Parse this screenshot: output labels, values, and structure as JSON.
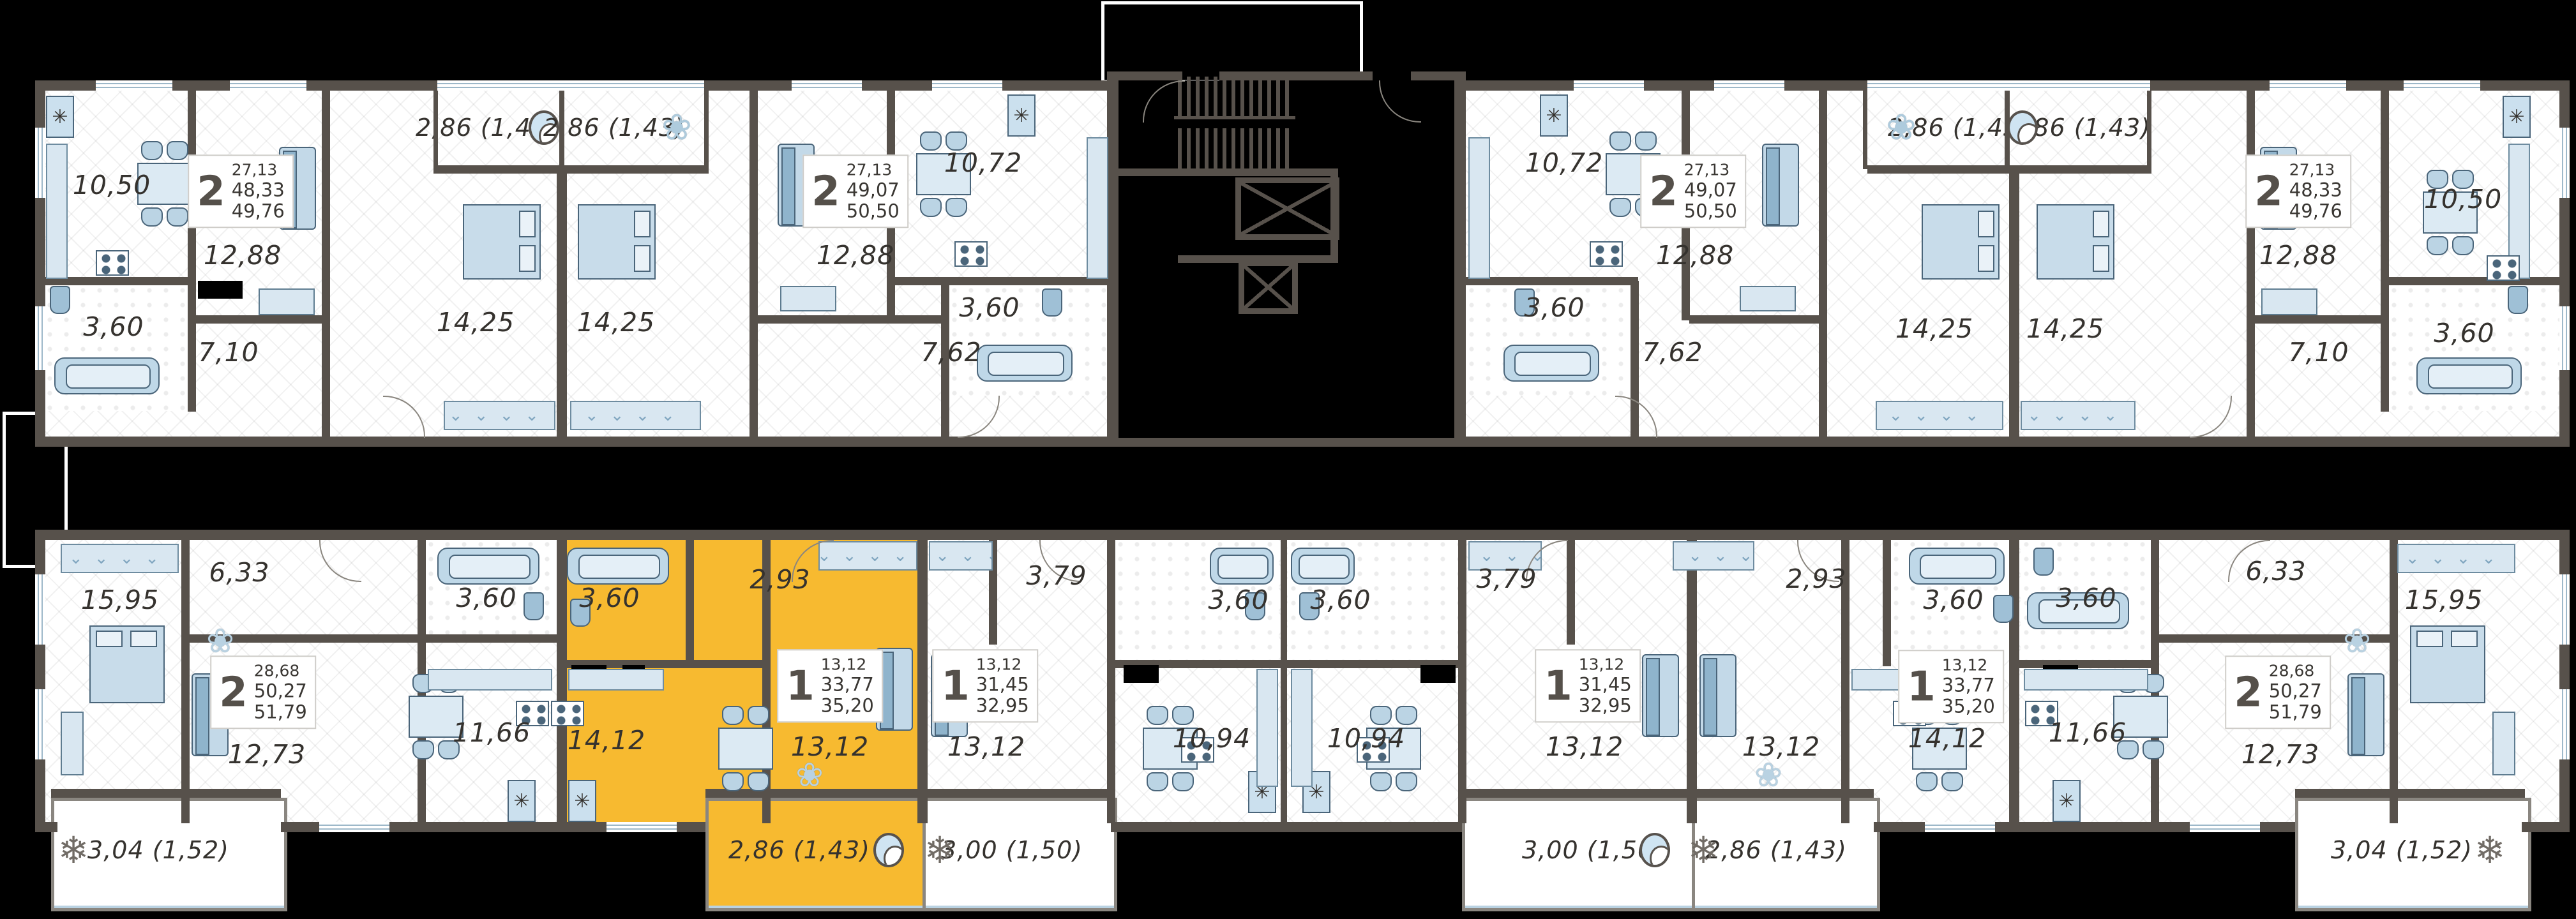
{
  "colors": {
    "background": "#000000",
    "walls": "#57514B",
    "highlight": "#F7BA30",
    "furniture_light": "#D9E7F1",
    "furniture_mid": "#A9C9DD",
    "label_text": "#35322E"
  },
  "units": [
    {
      "id": "a1",
      "name": "apartment-2room-49,76-top-left",
      "rooms_count": "2",
      "area_living": "27,13",
      "area_main": "48,33",
      "area_total": "49,76",
      "highlighted": false,
      "rooms": [
        {
          "id": "kitchen",
          "area": "10,50"
        },
        {
          "id": "living",
          "area": "12,88"
        },
        {
          "id": "bath",
          "area": "3,60"
        },
        {
          "id": "hall",
          "area": "7,10"
        },
        {
          "id": "bedroom",
          "area": "14,25"
        }
      ],
      "balconies": [
        {
          "area": "2,86 (1,43)",
          "icon": "chair"
        }
      ]
    },
    {
      "id": "a2",
      "name": "apartment-2room-50,50-top-left-center",
      "rooms_count": "2",
      "area_living": "27,13",
      "area_main": "49,07",
      "area_total": "50,50",
      "highlighted": false,
      "rooms": [
        {
          "id": "bedroom",
          "area": "14,25"
        },
        {
          "id": "living",
          "area": "12,88"
        },
        {
          "id": "kitchen",
          "area": "10,72"
        },
        {
          "id": "bath",
          "area": "3,60"
        },
        {
          "id": "hall",
          "area": "7,62"
        }
      ],
      "balconies": [
        {
          "area": "2,86 (1,43)",
          "icon": "plant"
        }
      ]
    },
    {
      "id": "a3",
      "name": "apartment-2room-50,50-top-right-center",
      "rooms_count": "2",
      "area_living": "27,13",
      "area_main": "49,07",
      "area_total": "50,50",
      "highlighted": false,
      "rooms": [
        {
          "id": "kitchen",
          "area": "10,72"
        },
        {
          "id": "living",
          "area": "12,88"
        },
        {
          "id": "bath",
          "area": "3,60"
        },
        {
          "id": "hall",
          "area": "7,62"
        },
        {
          "id": "bedroom",
          "area": "14,25"
        }
      ],
      "balconies": [
        {
          "area": "2,86 (1,43)",
          "icon": "plant"
        }
      ]
    },
    {
      "id": "a4",
      "name": "apartment-2room-49,76-top-right",
      "rooms_count": "2",
      "area_living": "27,13",
      "area_main": "48,33",
      "area_total": "49,76",
      "highlighted": false,
      "rooms": [
        {
          "id": "bedroom",
          "area": "14,25"
        },
        {
          "id": "living",
          "area": "12,88"
        },
        {
          "id": "kitchen",
          "area": "10,50"
        },
        {
          "id": "bath",
          "area": "3,60"
        },
        {
          "id": "hall",
          "area": "7,10"
        }
      ],
      "balconies": [
        {
          "area": "2,86 (1,43)",
          "icon": "chair"
        }
      ]
    },
    {
      "id": "b1",
      "name": "apartment-2room-51,79-bottom-left",
      "rooms_count": "2",
      "area_living": "28,68",
      "area_main": "50,27",
      "area_total": "51,79",
      "highlighted": false,
      "rooms": [
        {
          "id": "bedroom",
          "area": "15,95"
        },
        {
          "id": "hall",
          "area": "6,33"
        },
        {
          "id": "living",
          "area": "12,73"
        },
        {
          "id": "kitchen",
          "area": "11,66"
        },
        {
          "id": "bath",
          "area": "3,60"
        }
      ],
      "balconies": [
        {
          "area": "3,04 (1,52)",
          "icon": "fern"
        }
      ]
    },
    {
      "id": "b2",
      "name": "apartment-1room-35,20-highlighted",
      "rooms_count": "1",
      "area_living": "13,12",
      "area_main": "33,77",
      "area_total": "35,20",
      "highlighted": true,
      "rooms": [
        {
          "id": "bath",
          "area": "3,60"
        },
        {
          "id": "hall",
          "area": "2,93"
        },
        {
          "id": "kitchen",
          "area": "14,12"
        },
        {
          "id": "room",
          "area": "13,12"
        }
      ],
      "balconies": [
        {
          "area": "2,86 (1,43)",
          "icon": "chair"
        }
      ]
    },
    {
      "id": "b3",
      "name": "apartment-1room-32,95-bottom-left-center",
      "rooms_count": "1",
      "area_living": "13,12",
      "area_main": "31,45",
      "area_total": "32,95",
      "highlighted": false,
      "rooms": [
        {
          "id": "room",
          "area": "13,12"
        },
        {
          "id": "hall",
          "area": "3,79"
        },
        {
          "id": "bath",
          "area": "3,60"
        },
        {
          "id": "kitchen",
          "area": "10,94"
        }
      ],
      "balconies": [
        {
          "area": "3,00 (1,50)",
          "icon": "fern"
        }
      ]
    },
    {
      "id": "b4",
      "name": "apartment-1room-32,95-bottom-right-center",
      "rooms_count": "1",
      "area_living": "13,12",
      "area_main": "31,45",
      "area_total": "32,95",
      "highlighted": false,
      "rooms": [
        {
          "id": "bath",
          "area": "3,60"
        },
        {
          "id": "kitchen",
          "area": "10,94"
        },
        {
          "id": "hall",
          "area": "3,79"
        },
        {
          "id": "room",
          "area": "13,12"
        }
      ],
      "balconies": [
        {
          "area": "3,00 (1,50)",
          "icon": "chair"
        }
      ]
    },
    {
      "id": "b5",
      "name": "apartment-1room-35,20-bottom-right-center",
      "rooms_count": "1",
      "area_living": "13,12",
      "area_main": "33,77",
      "area_total": "35,20",
      "highlighted": false,
      "rooms": [
        {
          "id": "room",
          "area": "13,12"
        },
        {
          "id": "hall",
          "area": "2,93"
        },
        {
          "id": "bath",
          "area": "3,60"
        },
        {
          "id": "kitchen",
          "area": "14,12"
        }
      ],
      "balconies": [
        {
          "area": "2,86 (1,43)",
          "icon": "fern"
        }
      ]
    },
    {
      "id": "b6",
      "name": "apartment-2room-51,79-bottom-right",
      "rooms_count": "2",
      "area_living": "28,68",
      "area_main": "50,27",
      "area_total": "51,79",
      "highlighted": false,
      "rooms": [
        {
          "id": "bath",
          "area": "3,60"
        },
        {
          "id": "kitchen",
          "area": "11,66"
        },
        {
          "id": "hall",
          "area": "6,33"
        },
        {
          "id": "living",
          "area": "12,73"
        },
        {
          "id": "bedroom",
          "area": "15,95"
        }
      ],
      "balconies": [
        {
          "area": "3,04 (1,52)",
          "icon": "fern"
        }
      ]
    }
  ],
  "core": {
    "name": "stair-elevator-core"
  }
}
